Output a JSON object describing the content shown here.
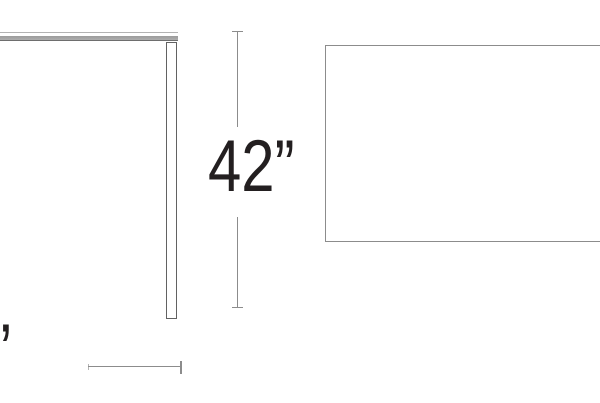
{
  "window": {
    "width_px": 600,
    "height_px": 403,
    "background": "#ffffff"
  },
  "diagram": {
    "kind": "furniture-dimension-drawing",
    "views": {
      "side_view": "table side profile with tabletop edge and one leg (cropped at left edge)",
      "top_view": "table top outline rectangle (cropped at right edge)"
    },
    "dimensions": {
      "height": {
        "label": "42”",
        "value_inches": 42
      },
      "depth": {
        "label_fragment": "”"
      }
    },
    "colors": {
      "dimension_line": "#8c8c8c",
      "leg_outline": "#626262",
      "top_view_outline": "#8c8c8c",
      "tabletop_fill": "#a2a2a2",
      "tabletop_edge_dark": "#6e6e6e",
      "label_text": "#231f20",
      "background": "#ffffff"
    }
  }
}
